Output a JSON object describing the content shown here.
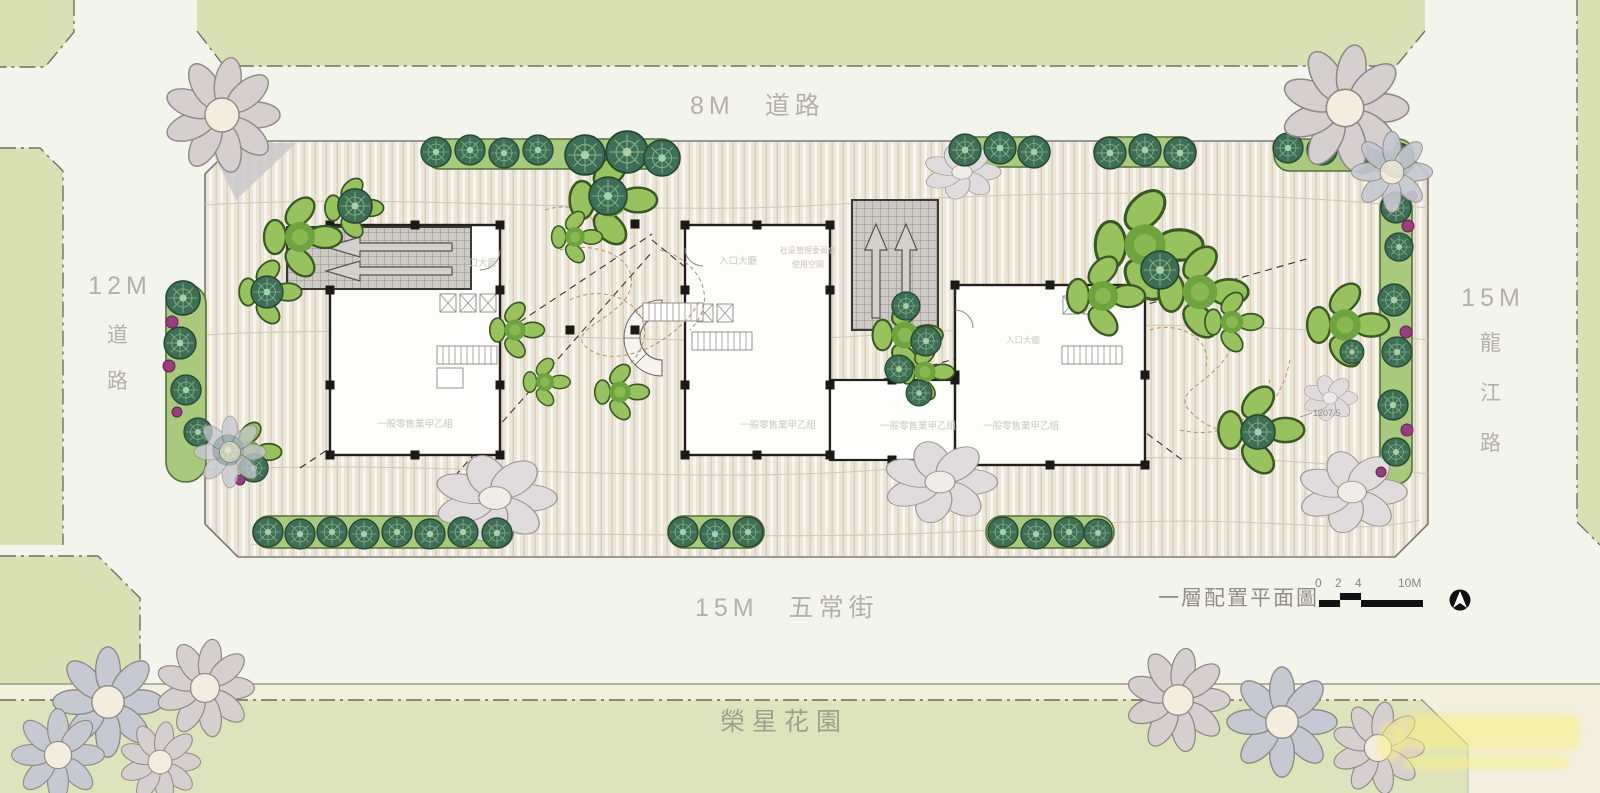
{
  "roads": {
    "top": {
      "size": "8M",
      "name": "道路"
    },
    "left": {
      "size": "12M",
      "chars": [
        "道",
        "路"
      ]
    },
    "right": {
      "size": "15M",
      "chars": [
        "龍",
        "江",
        "路"
      ]
    },
    "bottom": {
      "size": "15M",
      "name": "五常街"
    }
  },
  "park": {
    "label": "榮星花園"
  },
  "legend": {
    "title": "一層配置平面圖",
    "scale_ticks": [
      "0",
      "2",
      "4",
      "10M"
    ]
  },
  "annotations": {
    "dimension": "1207.5"
  },
  "buildings": {
    "b1": {
      "lobby": "入口大廳",
      "retail": "一般零售業甲乙組"
    },
    "b2": {
      "lobby": "入口大廳",
      "mgmt_line1": "社區管理委員會",
      "mgmt_line2": "使用空間",
      "retail": "一般零售業甲乙組"
    },
    "b3": {
      "lobby": "入口大廳"
    },
    "mid": {
      "retail_left": "一般零售業甲乙組",
      "retail_right": "一般零售業甲乙組"
    }
  }
}
